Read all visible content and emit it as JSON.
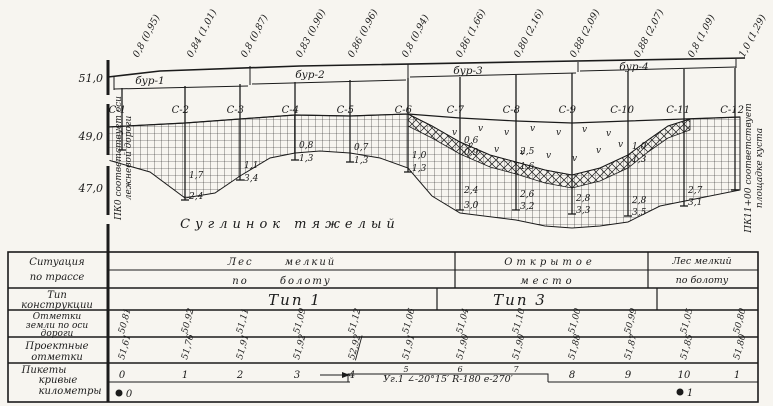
{
  "colors": {
    "paper": "#f7f5f0",
    "ink": "#1b1b1b"
  },
  "profile": {
    "top_labels": [
      "0,8 (0,95)",
      "0,84 (1,01)",
      "0,8 (0,87)",
      "0,83 (0,90)",
      "0,86 (0,96)",
      "0,8 (0,94)",
      "0,86 (1,66)",
      "0,80 (2,16)",
      "0,88 (2,09)",
      "0,88 (2,07)",
      "0,8 (1,09)",
      "1,0 (1,29)"
    ],
    "elevations": [
      "51,0",
      "49,0",
      "47,0"
    ],
    "left_note": [
      "ПК0 соответствует оси",
      "лежневой дороги"
    ],
    "right_note": [
      "ПК11+00 соответствует",
      "площадке куста"
    ],
    "borehole_groups": [
      "бур-1",
      "бур-2",
      "бур-3",
      "бур-4"
    ],
    "marsh_symbol": "v",
    "soil_label": "Суглинок тяжелый",
    "soundings": [
      {
        "label": "С-1",
        "depths": []
      },
      {
        "label": "С-2",
        "depths": [
          "1,7",
          "2,4"
        ]
      },
      {
        "label": "С-3",
        "depths": [
          "1,1",
          "3,4"
        ]
      },
      {
        "label": "С-4",
        "depths": [
          "0,8",
          "1,3"
        ]
      },
      {
        "label": "С-5",
        "depths": [
          "0,7",
          "1,3"
        ]
      },
      {
        "label": "С-6",
        "depths": [
          "1,0",
          "1,3"
        ]
      },
      {
        "label": "С-7",
        "depths": [
          "0,6",
          "0,9",
          "2,4",
          "3,0"
        ]
      },
      {
        "label": "С-8",
        "depths": [
          "2,5",
          "1,6",
          "2,6",
          "3,2"
        ]
      },
      {
        "label": "С-9",
        "depths": [
          "2,8",
          "3,3"
        ]
      },
      {
        "label": "С-10",
        "depths": [
          "1,0",
          "1,3",
          "2,8",
          "3,5"
        ]
      },
      {
        "label": "С-11",
        "depths": [
          "2,7",
          "3,1"
        ]
      },
      {
        "label": "С-12",
        "depths": []
      }
    ]
  },
  "table": {
    "row_headers": [
      [
        "Ситуация",
        "по трассе"
      ],
      [
        "Тип",
        "конструкции"
      ],
      [
        "Отметки",
        "земли по оси",
        "дороги"
      ],
      [
        "Проектные",
        "отметки"
      ],
      [
        "Пикеты",
        "кривые",
        "километры"
      ]
    ],
    "situation": [
      {
        "top": "Лес мелкий",
        "bottom": "по болоту"
      },
      {
        "top": "Открытое",
        "bottom": "место"
      },
      {
        "top": "Лес мелкий",
        "bottom": "по болоту"
      }
    ],
    "construction_types": [
      "Тип 1",
      "Тип 3"
    ],
    "ground_marks": [
      "50,81",
      "50,92",
      "51,11",
      "51,09",
      "51,12",
      "51,06",
      "51,04",
      "51,10",
      "51,00",
      "50,99",
      "51,05",
      "50,80"
    ],
    "design_marks": [
      "51,61",
      "51,76",
      "51,91",
      "51,92",
      "52,92",
      "51,91",
      "51,90",
      "51,90",
      "51,88",
      "51,87",
      "51,85",
      "51,80"
    ],
    "pickets": [
      "0",
      "1",
      "2",
      "3",
      "4",
      "5",
      "6",
      "7",
      "8",
      "9",
      "10",
      "1"
    ],
    "curve_note": "Уг.1 ∠-20°15′ R-180 е-270′",
    "kilometers": [
      "0",
      "1"
    ]
  }
}
